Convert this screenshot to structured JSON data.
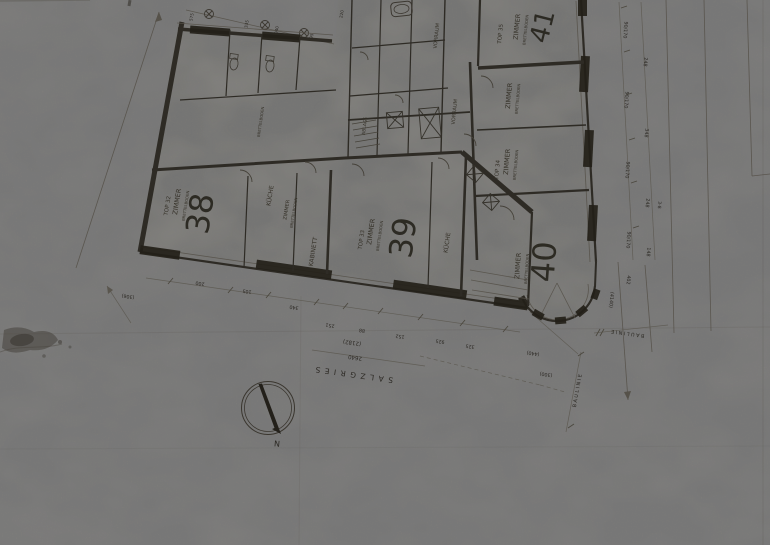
{
  "plan": {
    "units": [
      {
        "top_label": "TOP 32",
        "number": "38"
      },
      {
        "top_label": "TOP 33",
        "number": "39"
      },
      {
        "top_label": "TOP 34",
        "number": "40"
      },
      {
        "top_label": "TOP 35",
        "number": "41"
      }
    ],
    "room_labels": {
      "zimmer": "ZIMMER",
      "kueche": "KÜCHE",
      "kabinett": "KABINETT",
      "vorraum": "VORRAUM",
      "ablage": "ABLAGE",
      "floor_note": "BRETTELBODEN"
    },
    "street": {
      "name": "SALZGRIES",
      "dim_main": "2640",
      "dim_paren": "(2182)"
    },
    "north_label": "N",
    "site_labels": {
      "bauline": "BAULINIE"
    },
    "dimensions": {
      "bottom_chain": [
        "200",
        "105",
        "340",
        "251",
        "88",
        "152",
        "925",
        "325"
      ],
      "bottom_extra": [
        "(306)",
        "(440)",
        "(300)",
        "(4140)",
        "402"
      ],
      "right_windows": "90/170",
      "right_spacing": [
        "248",
        "348",
        "248",
        "148"
      ],
      "right_marker": "3-8",
      "top_chain": [
        "575",
        "335",
        "040",
        "95",
        "220"
      ]
    }
  }
}
